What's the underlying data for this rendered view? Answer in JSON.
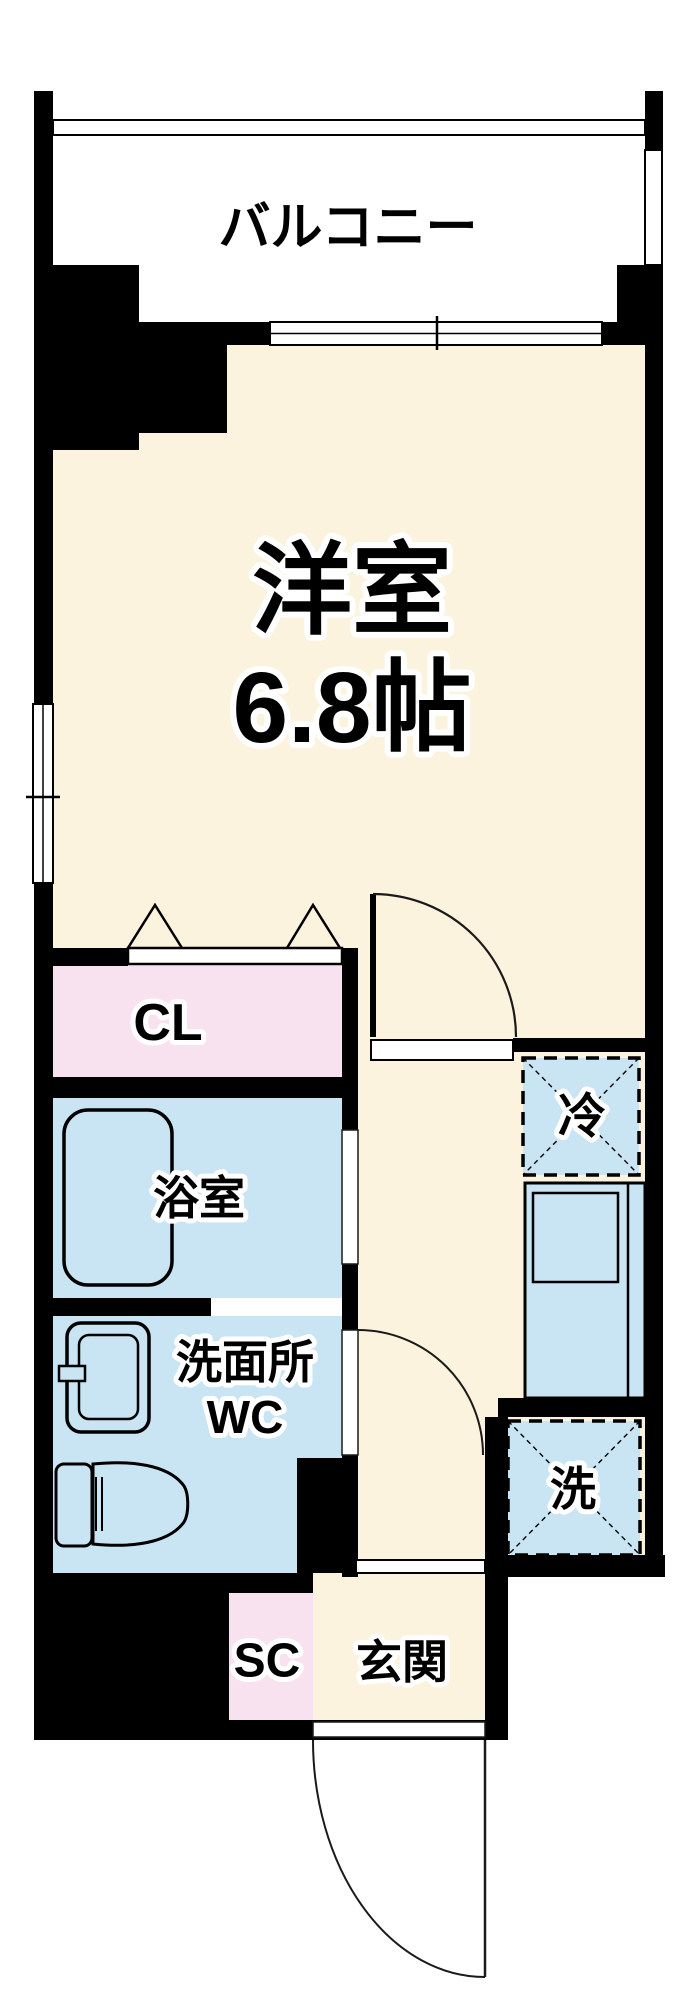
{
  "plan": {
    "balcony": "バルコニー",
    "room": "洋室",
    "room_size": "6.8帖",
    "closet": "CL",
    "bath": "浴室",
    "washroom": "洗面所",
    "wc": "WC",
    "fridge": "冷",
    "washer": "洗",
    "shoe_closet": "SC",
    "entrance": "玄関"
  },
  "colors": {
    "wall": "#000000",
    "room_floor": "#FCF3DE",
    "wet_floor": "#C9E4F3",
    "closet_floor": "#F9E2EF",
    "opening": "#FFFFFF",
    "line": "#1A1A1A",
    "background": "#FFFFFF"
  }
}
